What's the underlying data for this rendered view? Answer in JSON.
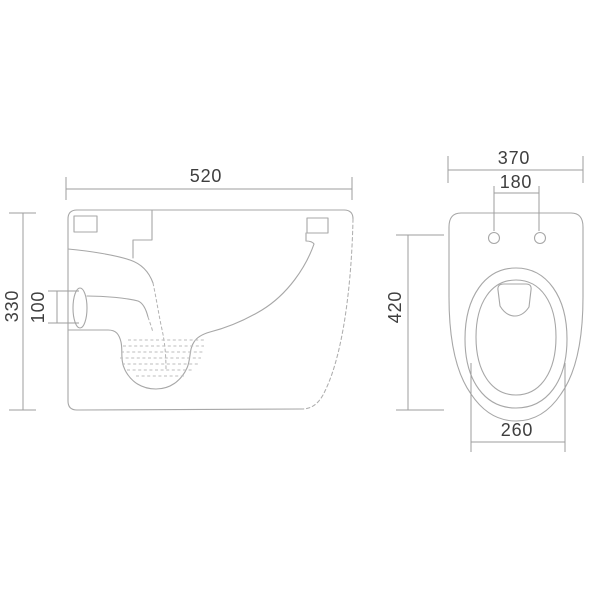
{
  "colors": {
    "background": "#ffffff",
    "geometry_line": "#a7a7a7",
    "hidden_line": "#b2b2b2",
    "dimension_line": "#9d9d9d",
    "label_text": "#3e3e3e"
  },
  "side_view": {
    "dim_width": "520",
    "dim_height": "330",
    "dim_outlet": "100"
  },
  "front_view": {
    "dim_width": "370",
    "dim_hole_spacing": "180",
    "dim_height": "420",
    "dim_bowl_width": "260"
  }
}
